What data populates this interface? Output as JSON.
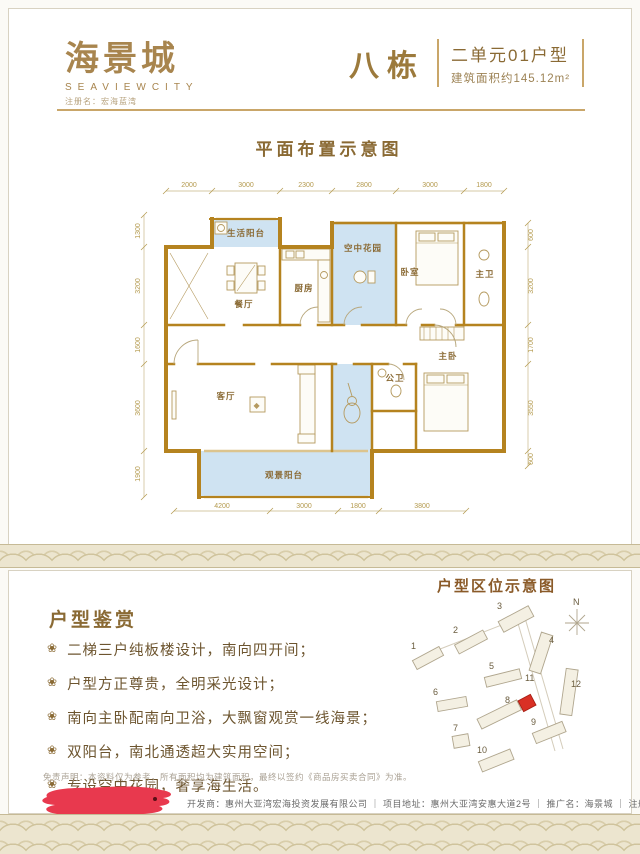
{
  "header": {
    "logo_cn": "海景城",
    "logo_en": "SEAVIEWCITY",
    "logo_reg": "注册名：宏海蓝湾",
    "building": "八栋",
    "unit_type": "二单元01户型",
    "area": "建筑面积约145.12m²"
  },
  "plan": {
    "title": "平面布置示意图",
    "top_dims": [
      "2000",
      "3000",
      "2300",
      "2800",
      "3000",
      "1800"
    ],
    "bottom_dims": [
      "4200",
      "3000",
      "1800",
      "3800"
    ],
    "left_dims": [
      "1300",
      "3200",
      "1600",
      "3600",
      "1900"
    ],
    "right_dims": [
      "600",
      "3200",
      "1700",
      "3550",
      "600"
    ],
    "rooms": {
      "life_balcony": "生活阳台",
      "dining": "餐厅",
      "kitchen": "厨房",
      "sky_garden": "空中花园",
      "bedroom": "卧室",
      "master_bath": "主卫",
      "master_bedroom": "主卧",
      "living": "客厅",
      "public_bath": "公卫",
      "view_balcony": "观景阳台"
    }
  },
  "appreciation": {
    "title": "户型鉴赏",
    "bullet_icon": "❀",
    "items": [
      "二梯三户纯板楼设计，南向四开间；",
      "户型方正尊贵，全明采光设计；",
      "南向主卧配南向卫浴，大飘窗观赏一线海景；",
      "双阳台，南北通透超大实用空间；",
      "专设空中花园，奢享海生活。"
    ],
    "disclaimer": "免责声明：本资料仅为参考，所有面积均为建筑面积，最终以签约《商品房买卖合同》为准。"
  },
  "site_map": {
    "title": "户型区位示意图",
    "north": "N",
    "buildings": [
      "1",
      "2",
      "3",
      "4",
      "5",
      "6",
      "7",
      "8",
      "9",
      "10",
      "11",
      "12"
    ]
  },
  "footer": {
    "info": "开发商：惠州大亚湾宏海投资发展有限公司 ｜ 项目地址：惠州大亚湾安惠大道2号 ｜ 推广名：海景城 ｜ 注册名：宏海蓝湾"
  },
  "colors": {
    "wall": "#b5831f",
    "balcony_blue": "#cfe3f2",
    "brand": "#9c7a3c",
    "redaction_red": "#e8394e",
    "highlight_red": "#d93025"
  }
}
